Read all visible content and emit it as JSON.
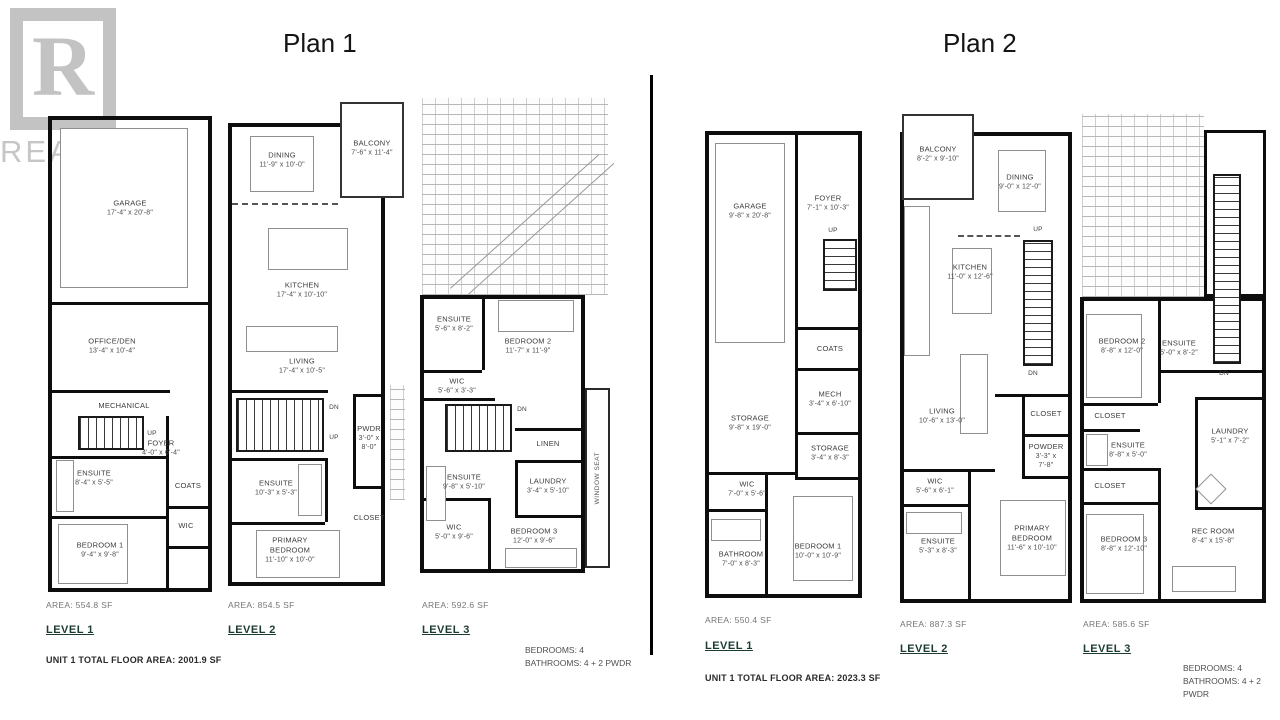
{
  "watermark": {
    "logo_letter": "R",
    "text": "REALTOR",
    "registered": "®"
  },
  "plans": [
    {
      "title": "Plan 1",
      "total": "UNIT 1 TOTAL FLOOR AREA: 2001.9 SF",
      "summary": {
        "bedrooms": "BEDROOMS: 4",
        "bathrooms": "BATHROOMS: 4 + 2 PWDR"
      },
      "levels": [
        {
          "name": "LEVEL 1",
          "area": "AREA: 554.8 SF",
          "rooms": [
            {
              "name": "GARAGE",
              "dims": "17'-4\" x 20'-8\""
            },
            {
              "name": "OFFICE/DEN",
              "dims": "13'-4\" x 10'-4\""
            },
            {
              "name": "MECHANICAL"
            },
            {
              "name": "UP"
            },
            {
              "name": "FOYER",
              "dims": "4'-0\" x 6'-4\""
            },
            {
              "name": "ENSUITE",
              "dims": "8'-4\" x 5'-5\""
            },
            {
              "name": "COATS"
            },
            {
              "name": "WIC"
            },
            {
              "name": "BEDROOM 1",
              "dims": "9'-4\" x 9'-8\""
            }
          ]
        },
        {
          "name": "LEVEL 2",
          "area": "AREA: 854.5 SF",
          "rooms": [
            {
              "name": "DINING",
              "dims": "11'-9\" x 10'-0\""
            },
            {
              "name": "BALCONY",
              "dims": "7'-6\" x 11'-4\""
            },
            {
              "name": "KITCHEN",
              "dims": "17'-4\" x 10'-10\""
            },
            {
              "name": "LIVING",
              "dims": "17'-4\" x 10'-5\""
            },
            {
              "name": "DN"
            },
            {
              "name": "UP"
            },
            {
              "name": "ENSUITE",
              "dims": "10'-3\" x 5'-3\""
            },
            {
              "name": "PWDR",
              "dims": "3'-0\" x 8'-0\""
            },
            {
              "name": "CLOSET"
            },
            {
              "name": "PRIMARY BEDROOM",
              "dims": "11'-10\" x 10'-0\""
            }
          ]
        },
        {
          "name": "LEVEL 3",
          "area": "AREA: 592.6 SF",
          "rooms": [
            {
              "name": "ENSUITE",
              "dims": "5'-6\" x 8'-2\""
            },
            {
              "name": "BEDROOM 2",
              "dims": "11'-7\" x 11'-9\""
            },
            {
              "name": "WIC",
              "dims": "5'-6\" x 3'-3\""
            },
            {
              "name": "DN"
            },
            {
              "name": "LINEN"
            },
            {
              "name": "LAUNDRY",
              "dims": "3'-4\" x 5'-10\""
            },
            {
              "name": "ENSUITE",
              "dims": "9'-8\" x 5'-10\""
            },
            {
              "name": "WIC",
              "dims": "5'-0\" x 9'-6\""
            },
            {
              "name": "BEDROOM 3",
              "dims": "12'-0\" x 9'-6\""
            },
            {
              "name": "WINDOW SEAT"
            }
          ]
        }
      ]
    },
    {
      "title": "Plan 2",
      "total": "UNIT 1 TOTAL FLOOR AREA: 2023.3 SF",
      "summary": {
        "bedrooms": "BEDROOMS: 4",
        "bathrooms": "BATHROOMS: 4 + 2 PWDR"
      },
      "levels": [
        {
          "name": "LEVEL 1",
          "area": "AREA: 550.4 SF",
          "rooms": [
            {
              "name": "GARAGE",
              "dims": "9'-8\" x 20'-8\""
            },
            {
              "name": "FOYER",
              "dims": "7'-1\" x 10'-3\""
            },
            {
              "name": "UP"
            },
            {
              "name": "COATS"
            },
            {
              "name": "MECH",
              "dims": "3'-4\" x 6'-10\""
            },
            {
              "name": "STORAGE",
              "dims": "9'-8\" x 19'-0\""
            },
            {
              "name": "STORAGE",
              "dims": "3'-4\" x 8'-3\""
            },
            {
              "name": "WIC",
              "dims": "7'-0\" x 5'-6\""
            },
            {
              "name": "BATHROOM",
              "dims": "7'-0\" x 8'-3\""
            },
            {
              "name": "BEDROOM 1",
              "dims": "10'-0\" x 10'-9\""
            }
          ]
        },
        {
          "name": "LEVEL 2",
          "area": "AREA: 887.3 SF",
          "rooms": [
            {
              "name": "BALCONY",
              "dims": "8'-2\" x 9'-10\""
            },
            {
              "name": "DINING",
              "dims": "9'-0\" x 12'-0\""
            },
            {
              "name": "KITCHEN",
              "dims": "11'-0\" x 12'-6\""
            },
            {
              "name": "UP"
            },
            {
              "name": "DN"
            },
            {
              "name": "LIVING",
              "dims": "10'-6\" x 13'-0\""
            },
            {
              "name": "CLOSET"
            },
            {
              "name": "POWDER",
              "dims": "3'-3\" x 7'-8\""
            },
            {
              "name": "WIC",
              "dims": "5'-6\" x 6'-1\""
            },
            {
              "name": "ENSUITE",
              "dims": "5'-3\" x 8'-3\""
            },
            {
              "name": "PRIMARY BEDROOM",
              "dims": "11'-6\" x 10'-10\""
            }
          ]
        },
        {
          "name": "LEVEL 3",
          "area": "AREA: 585.6 SF",
          "rooms": [
            {
              "name": "BEDROOM 2",
              "dims": "8'-8\" x 12'-0\""
            },
            {
              "name": "ENSUITE",
              "dims": "5'-0\" x 8'-2\""
            },
            {
              "name": "DN"
            },
            {
              "name": "CLOSET"
            },
            {
              "name": "ENSUITE",
              "dims": "8'-8\" x 5'-0\""
            },
            {
              "name": "LAUNDRY",
              "dims": "5'-1\" x 7'-2\""
            },
            {
              "name": "CLOSET"
            },
            {
              "name": "BEDROOM 3",
              "dims": "8'-8\" x 12'-10\""
            },
            {
              "name": "REC ROOM",
              "dims": "8'-4\" x 15'-8\""
            }
          ]
        }
      ]
    }
  ]
}
